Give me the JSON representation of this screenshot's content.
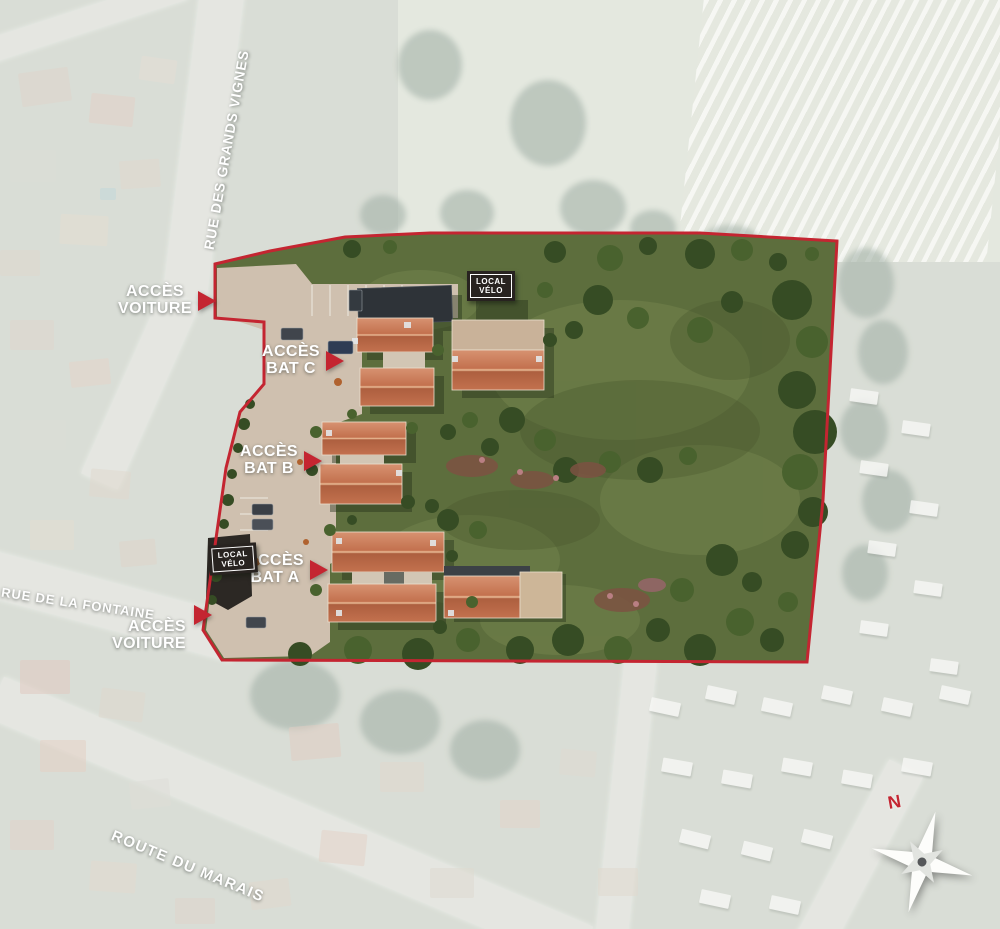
{
  "streets": {
    "grands_vignes": "RUE DES GRANDS VIGNES",
    "fontaine": "RUE DE LA FONTAINE",
    "marais": "ROUTE DU MARAIS"
  },
  "access": {
    "voiture_north": {
      "line1": "ACCÈS",
      "line2": "VOITURE"
    },
    "bat_c": {
      "line1": "ACCÈS",
      "line2": "BAT C"
    },
    "bat_b": {
      "line1": "ACCÈS",
      "line2": "BAT B"
    },
    "bat_a": {
      "line1": "ACCÈS",
      "line2": "BAT A"
    },
    "voiture_south": {
      "line1": "ACCÈS",
      "line2": "VOITURE"
    }
  },
  "bike_sheds": {
    "north": {
      "line1": "LOCAL",
      "line2": "VÉLO"
    },
    "south": {
      "line1": "LOCAL",
      "line2": "VÉLO"
    }
  },
  "compass": {
    "north": "N"
  },
  "colors": {
    "accent-red": "#c42531",
    "site-green": "#5d6e3d",
    "gravel": "#cfc0af",
    "roof-orange": "#c67452",
    "dark-roof": "#2e3338",
    "sign-dark": "#282320",
    "label-white": "#ffffff"
  }
}
